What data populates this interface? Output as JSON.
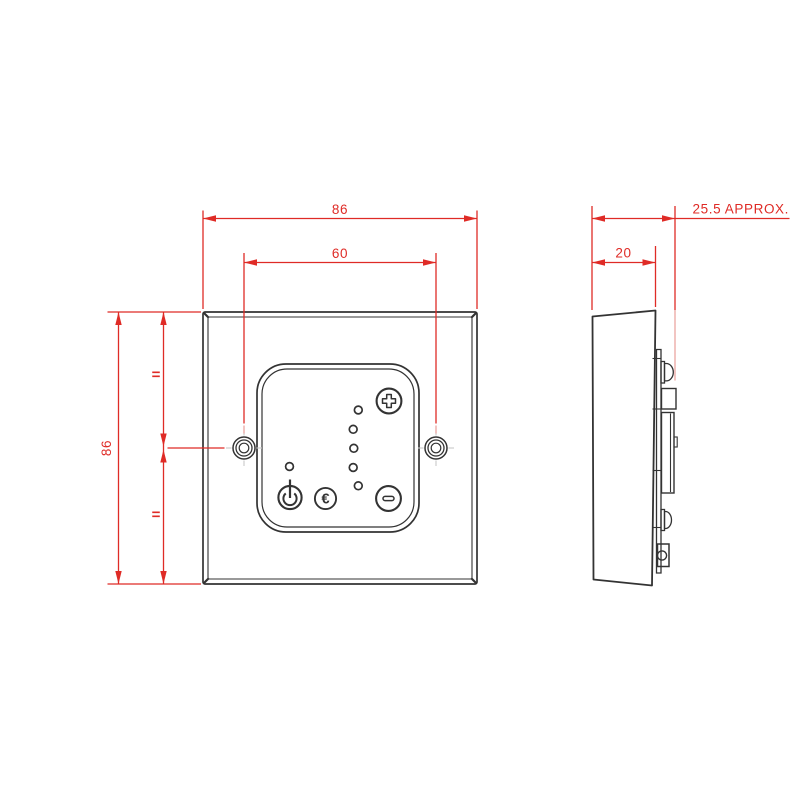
{
  "dimensions": {
    "front_width": "86",
    "hole_spacing": "60",
    "front_height": "86",
    "overall_depth": "25.5 APPROX.",
    "back_depth": "20",
    "equal_mark": "="
  },
  "front_view": {
    "buttons": {
      "power_glyph": "power-symbol",
      "eco_glyph": "€",
      "increase_glyph": "plus-symbol",
      "decrease_glyph": "minus-symbol"
    },
    "level_led_count": 5,
    "power_led_count": 1,
    "screw_hole_count": 2
  },
  "colors": {
    "dimension_red": "#df2b26",
    "outline_dark": "#333333",
    "background": "#ffffff"
  }
}
